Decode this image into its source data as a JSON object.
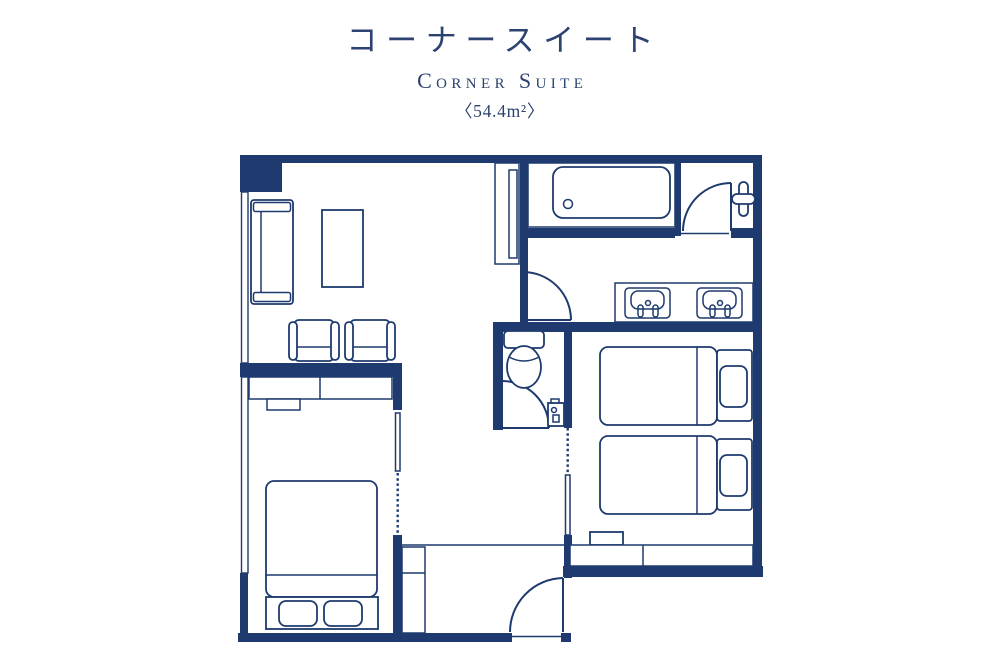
{
  "header": {
    "title_jp": "コーナースイート",
    "title_en": "Corner Suite",
    "area": "〈54.4m²〉"
  },
  "colors": {
    "line": "#1e3a6e",
    "text": "#2c4270",
    "background": "#ffffff"
  }
}
